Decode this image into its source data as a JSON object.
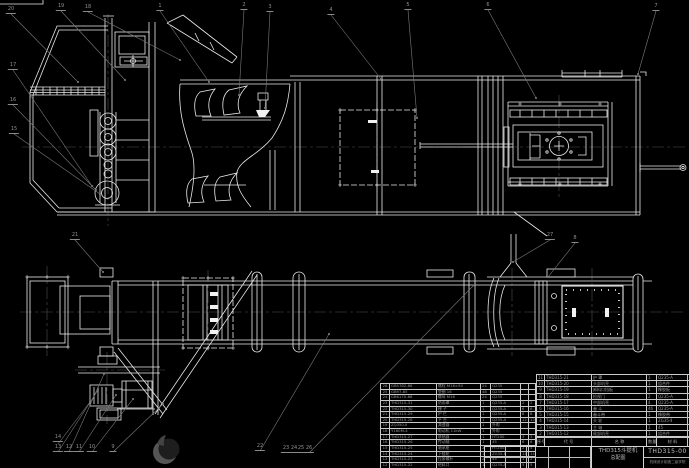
{
  "colors": {
    "background": "#000000",
    "drawing_lines": "#e9e9e9",
    "leader_lines": "#7a7a7a",
    "centerlines": "#4f4f4f",
    "table_text": "#989898",
    "title_text": "#b5b5b5"
  },
  "title_block": {
    "product": "THD315斗提机",
    "doc_type": "总配图",
    "drawing_no": "THD315-00",
    "org": "机械设计制造二级学院"
  },
  "bom_right": {
    "headers": [
      "序号",
      "代 号",
      "名 称",
      "数量",
      "材 料",
      "单重",
      "总重",
      "备注"
    ],
    "rows": [
      [
        "11",
        "THD315-21",
        "护 罩",
        "1",
        "Q235-A",
        "4",
        "4",
        ""
      ],
      [
        "10",
        "THD315-20",
        "头部机壳",
        "1",
        "组合件",
        "",
        "",
        ""
      ],
      [
        "9",
        "THD315-19",
        "卸料口挡板",
        "1",
        "橡胶板",
        "1",
        "1",
        ""
      ],
      [
        "8",
        "THD315-18",
        "检视门",
        "2",
        "Q235-A",
        "3",
        "6",
        ""
      ],
      [
        "7",
        "THD315-17",
        "中部机壳",
        "4",
        "Q235-A",
        "18",
        "72",
        ""
      ],
      [
        "6",
        "THD315-16",
        "畚 斗",
        "46",
        "Q235-A",
        "0.4",
        "18",
        ""
      ],
      [
        "5",
        "THD315-15",
        "畚斗带",
        "1",
        "橡胶带",
        "12",
        "12",
        ""
      ],
      [
        "4",
        "THD315-14",
        "头 轮",
        "1",
        "ZG35-Ⅱ",
        "26",
        "26",
        ""
      ],
      [
        "3",
        "THD315-13",
        "主 轴",
        "1",
        "45",
        "15",
        "15",
        ""
      ],
      [
        "2",
        "THD315-12",
        "尾部机壳",
        "1",
        "组合件",
        "",
        "",
        ""
      ]
    ]
  },
  "bom_left": {
    "rows": [
      [
        "26",
        "GB5782-86",
        "螺栓 M16×50",
        "24",
        "Q235",
        "",
        ""
      ],
      [
        "25",
        "GB97-85",
        "垫圈 16",
        "48",
        "Q235",
        "",
        ""
      ],
      [
        "24",
        "GB6170-86",
        "螺母 M16",
        "24",
        "Q235",
        "",
        ""
      ],
      [
        "23",
        "THD315-31",
        "防雨罩",
        "1",
        "Q235-A",
        "2",
        "2"
      ],
      [
        "22",
        "THD315-30",
        "梯 子",
        "1",
        "Q235-A",
        "6",
        "6"
      ],
      [
        "21",
        "THD315-29",
        "护 栏",
        "1",
        "Q235-A",
        "8",
        "8"
      ],
      [
        "20",
        "THD315-28",
        "平 台",
        "1",
        "Q235-A",
        "12",
        "12"
      ],
      [
        "19",
        "ZQ350-Ⅱ",
        "减速器",
        "1",
        "外购",
        "",
        ""
      ],
      [
        "18",
        "Y160M-4",
        "电动机 11kW",
        "1",
        "外购",
        "",
        ""
      ],
      [
        "17",
        "THD315-27",
        "联轴器",
        "1",
        "HT200",
        "3",
        "3"
      ],
      [
        "16",
        "THD315-26",
        "传动轴",
        "1",
        "45",
        "6",
        "6"
      ],
      [
        "15",
        "THD315-25",
        "轴承座",
        "2",
        "HT200",
        "2",
        "4"
      ],
      [
        "14",
        "THD315-24",
        "下链轮",
        "1",
        "ZG35-Ⅱ",
        "14",
        "14"
      ],
      [
        "13",
        "THD315-23",
        "拉紧螺杆",
        "2",
        "45",
        "1",
        "2"
      ],
      [
        "12",
        "THD315-22",
        "给料口",
        "1",
        "Q235-A",
        "5",
        "5"
      ]
    ]
  },
  "balloons": [
    {
      "x": 11,
      "y": 14,
      "label": "20"
    },
    {
      "x": 61,
      "y": 11,
      "label": "19"
    },
    {
      "x": 88,
      "y": 12,
      "label": "18"
    },
    {
      "x": 160,
      "y": 11,
      "label": "1"
    },
    {
      "x": 244,
      "y": 10,
      "label": "2"
    },
    {
      "x": 270,
      "y": 12,
      "label": "3"
    },
    {
      "x": 331,
      "y": 15,
      "label": "4"
    },
    {
      "x": 408,
      "y": 10,
      "label": "5"
    },
    {
      "x": 488,
      "y": 10,
      "label": "6"
    },
    {
      "x": 656,
      "y": 11,
      "label": "7"
    },
    {
      "x": 13,
      "y": 70,
      "label": "17"
    },
    {
      "x": 13,
      "y": 105,
      "label": "16"
    },
    {
      "x": 14,
      "y": 134,
      "label": "15"
    },
    {
      "x": 75,
      "y": 240,
      "label": "21"
    },
    {
      "x": 550,
      "y": 240,
      "label": "27"
    },
    {
      "x": 575,
      "y": 243,
      "label": "8"
    },
    {
      "x": 58,
      "y": 442,
      "label": "14"
    },
    {
      "x": 58,
      "y": 452,
      "label": "13"
    },
    {
      "x": 69,
      "y": 452,
      "label": "12"
    },
    {
      "x": 79,
      "y": 452,
      "label": "11"
    },
    {
      "x": 92,
      "y": 452,
      "label": "10"
    },
    {
      "x": 113,
      "y": 452,
      "label": "9"
    },
    {
      "x": 260,
      "y": 451,
      "label": "22"
    },
    {
      "x": 286,
      "y": 453,
      "label": "23"
    },
    {
      "x": 294,
      "y": 453,
      "label": "24"
    },
    {
      "x": 301,
      "y": 453,
      "label": "25"
    },
    {
      "x": 309,
      "y": 453,
      "label": "26"
    }
  ]
}
